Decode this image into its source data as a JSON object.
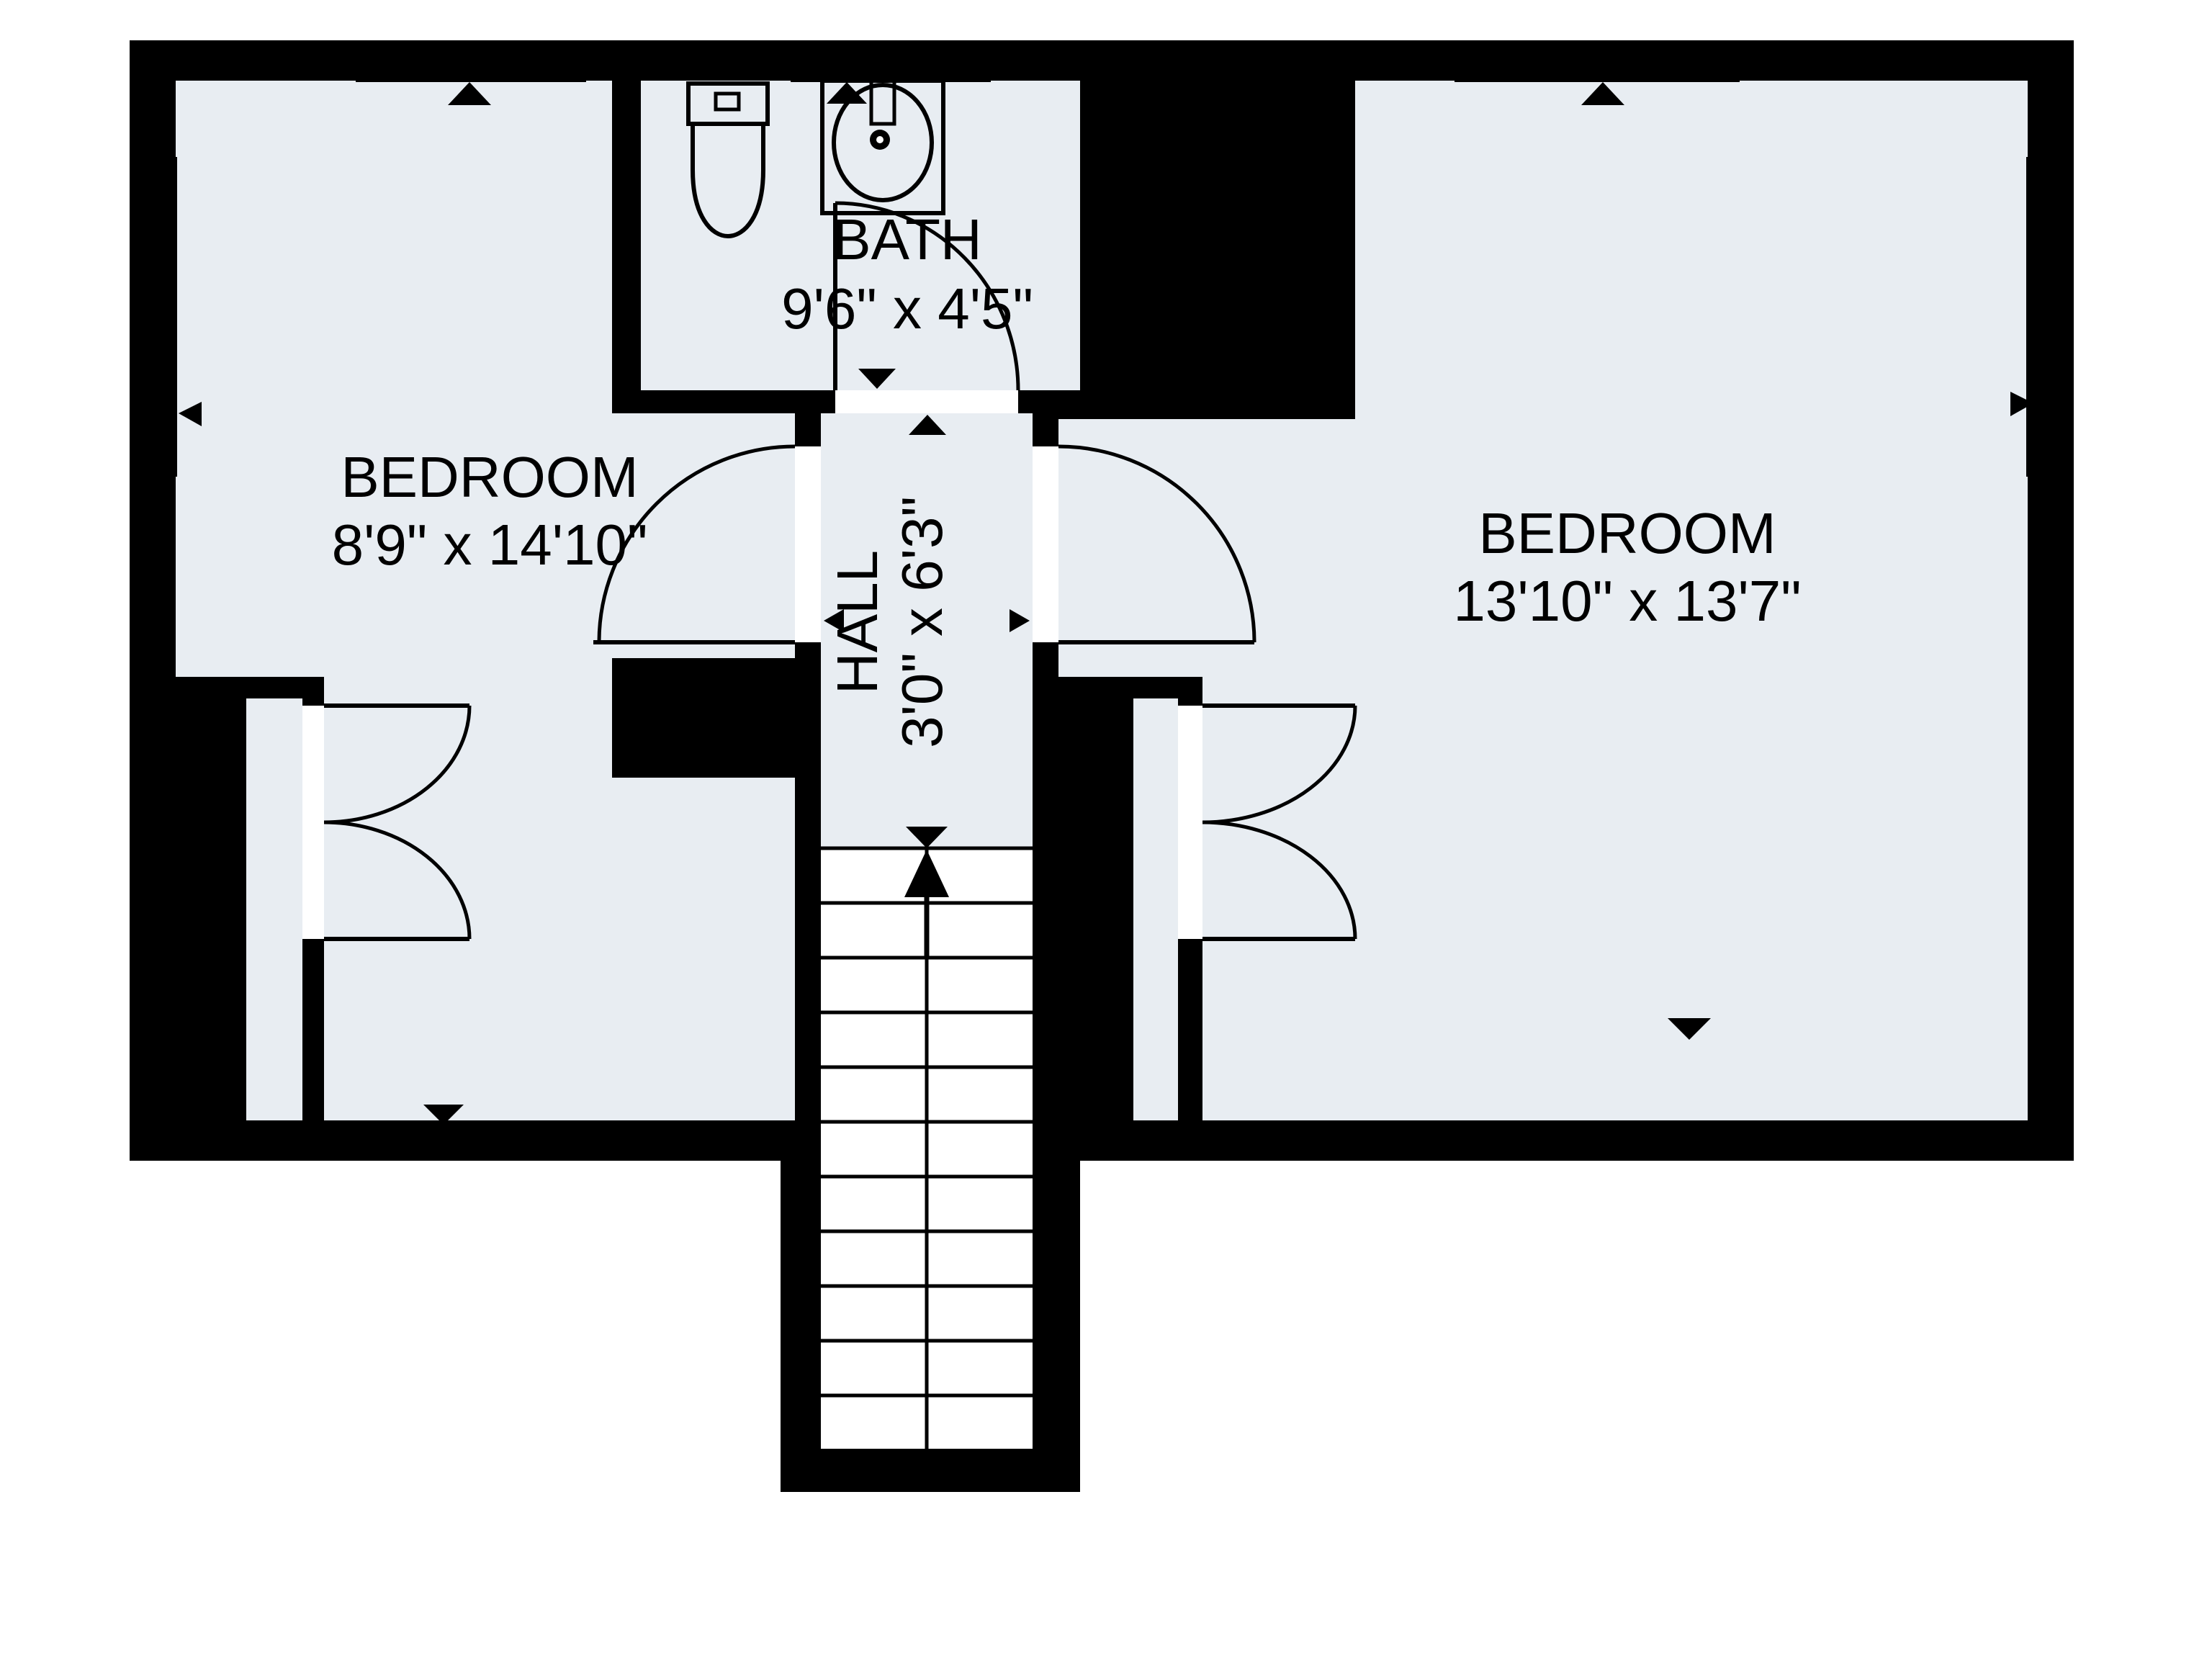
{
  "colors": {
    "background": "#ffffff",
    "wall": "#000000",
    "floor": "#e8edf2",
    "line": "#000000"
  },
  "rooms": {
    "bedroom_left": {
      "name": "BEDROOM",
      "dims": "8'9\" x 14'10\""
    },
    "bath": {
      "name": "BATH",
      "dims": "9'6\" x 4'5\""
    },
    "hall": {
      "name": "HALL",
      "dims": "3'0\" x 6'3\""
    },
    "bedroom_right": {
      "name": "BEDROOM",
      "dims": "13'10\" x 13'7\""
    }
  },
  "fixtures": {
    "toilet": "toilet-icon",
    "sink": "sink-icon",
    "shower": "shower-icon",
    "stairs": "stairs-up-arrow-icon",
    "closet_rod_left": "closet-rod-dashed-line",
    "closet_rod_right": "closet-rod-dashed-line"
  }
}
